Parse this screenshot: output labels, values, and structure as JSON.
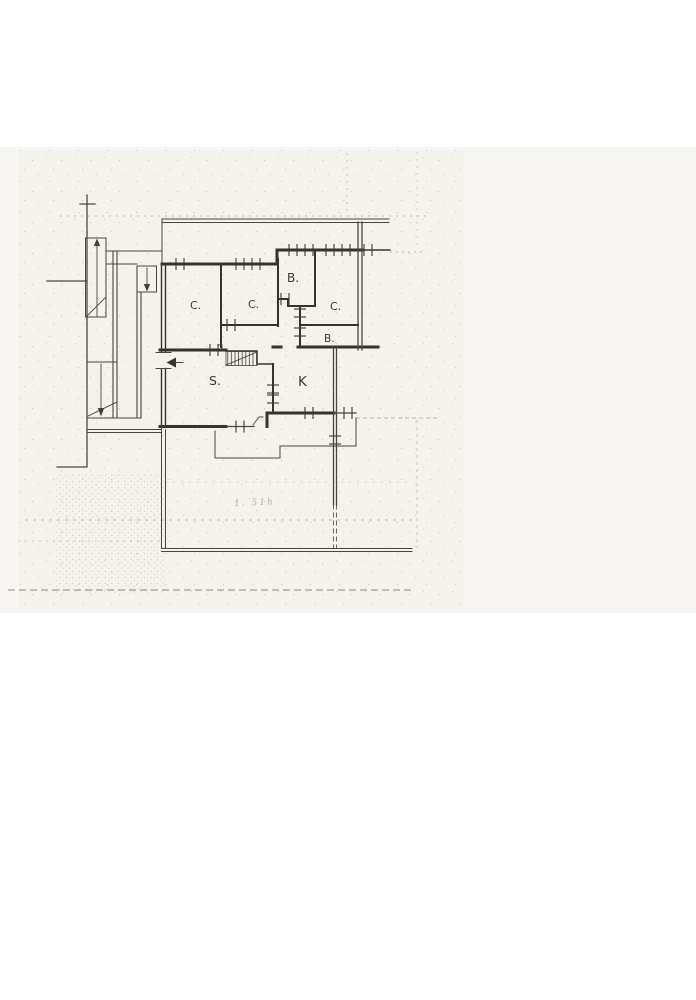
{
  "document_title": "",
  "rooms": [
    {
      "id": "bedroom-left",
      "label": "C."
    },
    {
      "id": "bedroom-middle",
      "label": "C."
    },
    {
      "id": "bath-top",
      "label": "B."
    },
    {
      "id": "bedroom-right",
      "label": "C."
    },
    {
      "id": "bath-small",
      "label": "B."
    },
    {
      "id": "living-room",
      "label": "S."
    },
    {
      "id": "kitchen",
      "label": "K"
    }
  ],
  "annotations": {
    "pencil_note": "1. 51h"
  },
  "colors": {
    "paper": "#ffffff",
    "scan_band": "#f7f6f2",
    "scan_inner": "#f2f1ea",
    "ink": "#3c3832",
    "wall": "#36332d",
    "thin": "#4a463f",
    "faint": "#bcb7aa",
    "pencil": "#a7a193",
    "speckle": "#c6c1b2"
  }
}
